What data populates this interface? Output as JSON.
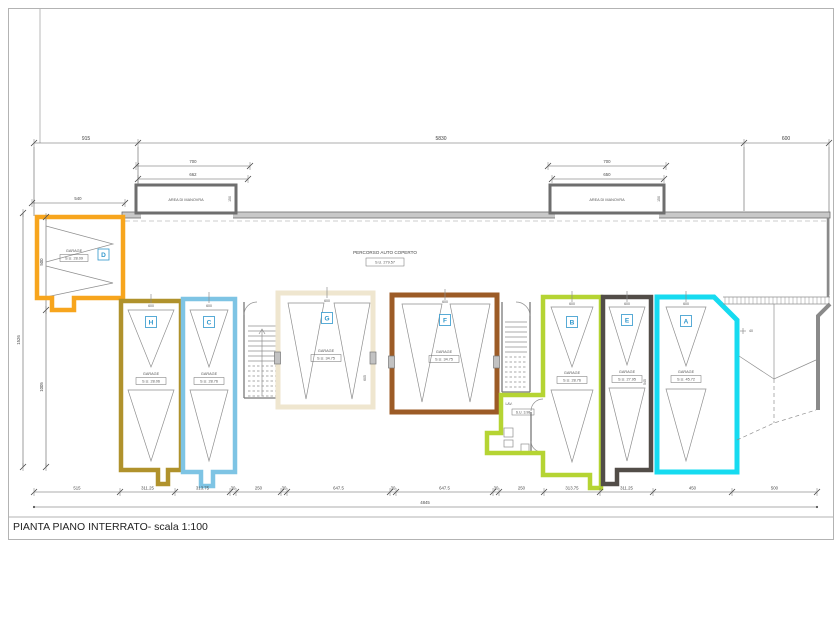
{
  "title_block": {
    "title": "PIANTA PIANO INTERRATO- scala 1:100"
  },
  "colors": {
    "garage_d": "#F7A51D",
    "garage_h": "#B0922C",
    "garage_c": "#7EC4E4",
    "garage_g": "#EFE6CF",
    "garage_f": "#9C5B26",
    "garage_b": "#B5D433",
    "garage_e": "#524D48",
    "garage_a": "#16DBF0",
    "wall_fill": "#C8C8C8",
    "line": "#8F8F8F",
    "badge_blue": "#2F97CC"
  },
  "labels": {
    "area_manovra_left": "AREA DI MANOVRA",
    "area_manovra_right": "AREA DI MANOVRA",
    "percorso": "PERCORSO AUTO COPERTO",
    "percorso_su": "S.U. 279.57"
  },
  "garages": {
    "d": {
      "letter": "D",
      "name": "GARAGE",
      "su": "S.U. 28.09"
    },
    "h": {
      "letter": "H",
      "name": "GARAGE",
      "su": "S.U. 28.06",
      "top_dim": "600"
    },
    "c": {
      "letter": "C",
      "name": "GARAGE",
      "su": "S.U. 28.76",
      "top_dim": "600"
    },
    "g": {
      "letter": "G",
      "name": "GARAGE",
      "su": "S.U. 34.75",
      "top_dim": "600"
    },
    "f": {
      "letter": "F",
      "name": "GARAGE",
      "su": "S.U. 34.75",
      "top_dim": "600"
    },
    "b": {
      "letter": "B",
      "name": "GARAGE",
      "su": "S.U. 28.76",
      "top_dim": "600"
    },
    "e": {
      "letter": "E",
      "name": "GARAGE",
      "su": "S.U. 27.95",
      "top_dim": "600"
    },
    "a": {
      "letter": "A",
      "name": "GARAGE",
      "su": "S.U. 45.72",
      "top_dim": "600"
    }
  },
  "annex": {
    "room_label": "LAV.",
    "room_su": "S.U. 3.98"
  },
  "dims": {
    "top": {
      "left": "915",
      "middle": "5830",
      "right": "600"
    },
    "manovra_left": {
      "outer": "700",
      "inner": "662"
    },
    "manovra_right": {
      "outer": "700",
      "inner": "650"
    },
    "manovra_depth_left": "150",
    "manovra_depth_right": "150",
    "d_width": "540",
    "left_total": "1526",
    "left_upper": "500",
    "left_lower": "1005",
    "g_side": "605",
    "e_side": "545",
    "a_corner": "40",
    "bottom": [
      "515",
      "311.25",
      "313.75",
      "30",
      "250",
      "30",
      "647.5",
      "30",
      "647.5",
      "30",
      "250",
      "313.75",
      "311.25",
      "450",
      "500"
    ],
    "bottom_total": "4845"
  }
}
